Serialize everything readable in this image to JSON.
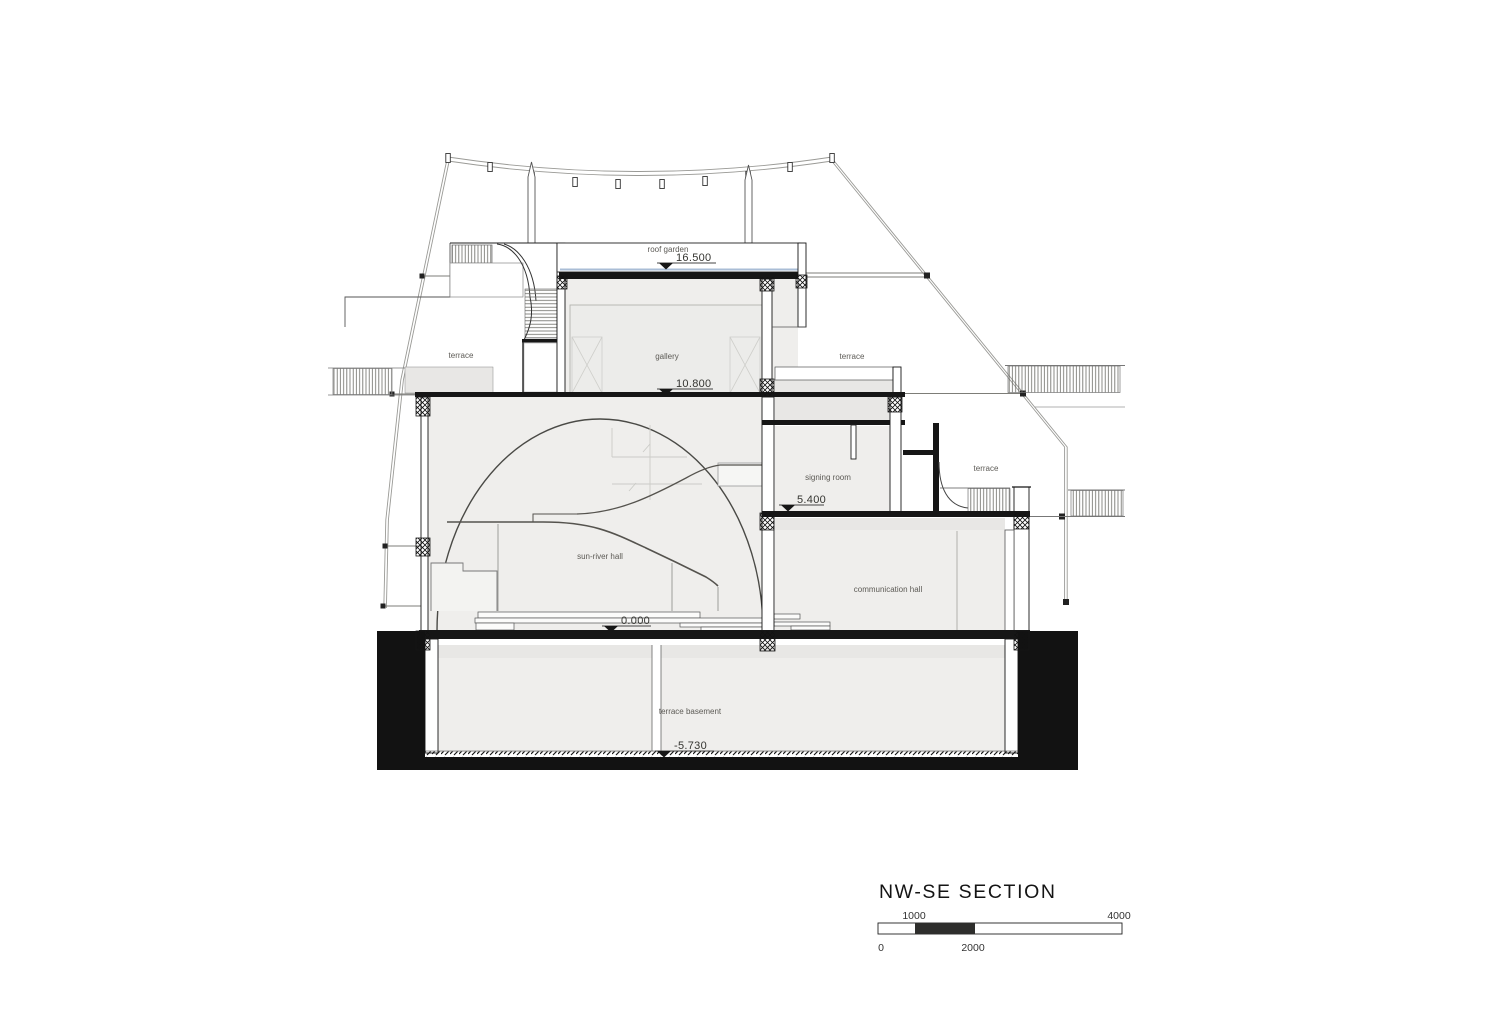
{
  "title": "NW-SE SECTION",
  "scale_bar": {
    "zero": "0",
    "one_thousand": "1000",
    "two_thousand": "2000",
    "four_thousand": "4000"
  },
  "rooms": {
    "roof_garden": "roof garden",
    "gallery": "gallery",
    "terrace_left": "terrace",
    "terrace_upper_right": "terrace",
    "terrace_mid_right": "terrace",
    "signing_room": "signing room",
    "sun_river_hall": "sun-river hall",
    "communication_hall": "communication hall",
    "terrace_basement": "terrace basement"
  },
  "levels": {
    "roof_garden": "16.500",
    "gallery_floor": "10.800",
    "signing_floor": "5.400",
    "ground": "0.000",
    "basement": "-5.730"
  },
  "colors": {
    "line": "#222222",
    "poche": "#121212",
    "room_fill": "#efeeec",
    "band_fill": "#e8e7e5",
    "accent_blue": "#a9bdd6"
  }
}
